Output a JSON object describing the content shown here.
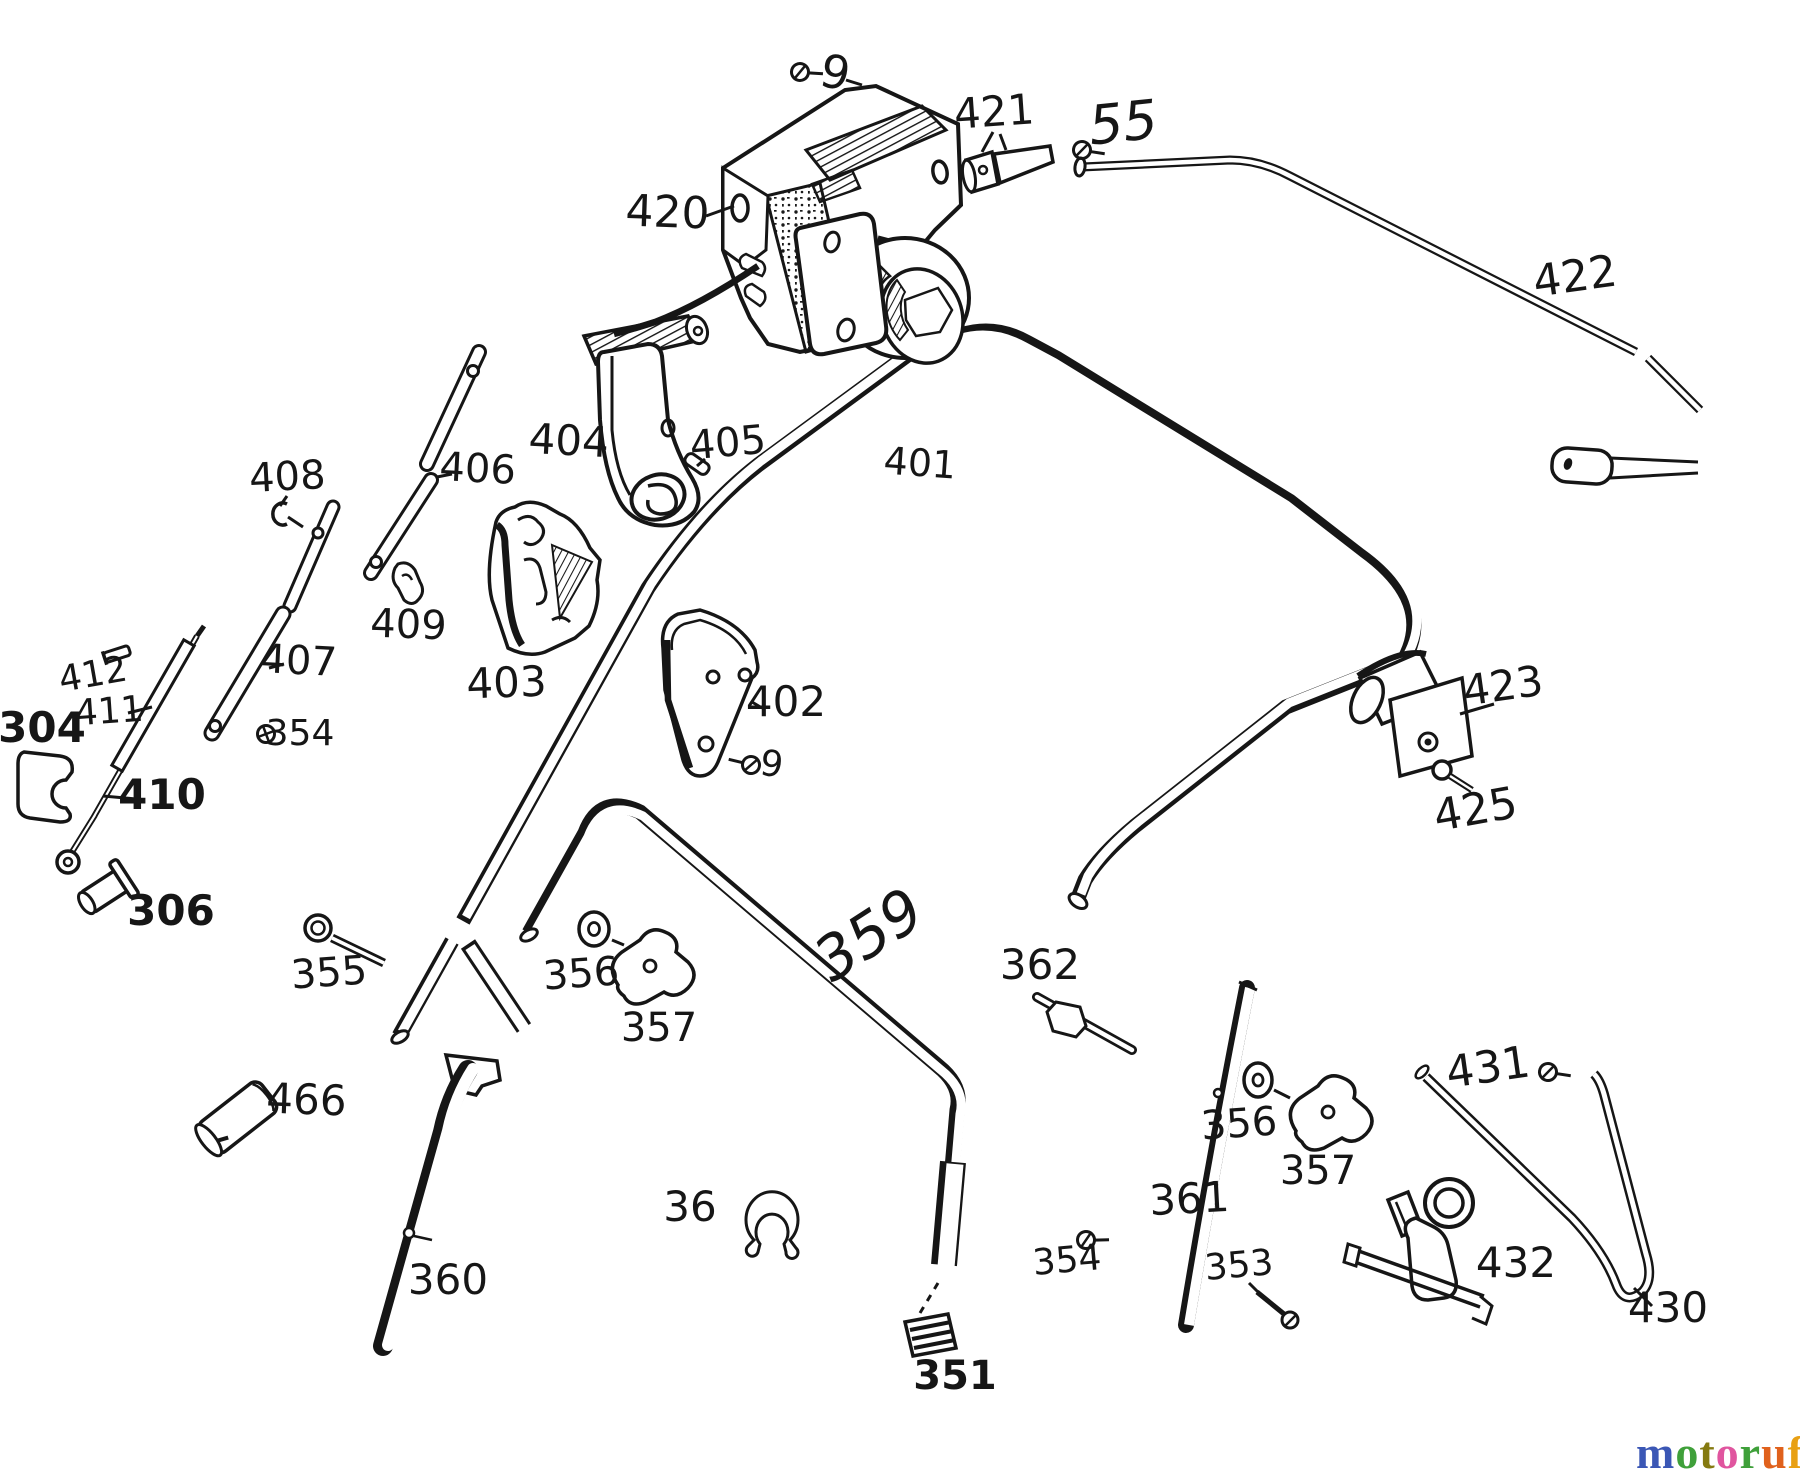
{
  "meta": {
    "background": "#ffffff",
    "ink": "#161616",
    "description": "Exploded spare-parts diagram of a lawn mower handlebar assembly"
  },
  "watermark": {
    "text": "motoruf",
    "suffix": ".de",
    "letters": [
      {
        "ch": "m",
        "color": "#3b57b5"
      },
      {
        "ch": "o",
        "color": "#3fa03a"
      },
      {
        "ch": "t",
        "color": "#857a10"
      },
      {
        "ch": "o",
        "color": "#e0559f"
      },
      {
        "ch": "r",
        "color": "#3fa03a"
      },
      {
        "ch": "u",
        "color": "#e0611c"
      },
      {
        "ch": "f",
        "color": "#e8a014"
      }
    ]
  },
  "diagram": {
    "labels": [
      {
        "id": "9-top",
        "text": "9",
        "x": 832,
        "y": 88,
        "size": 46,
        "rot": 12
      },
      {
        "id": "421",
        "text": "421",
        "x": 995,
        "y": 126,
        "size": 42,
        "rot": -4
      },
      {
        "id": "55",
        "text": "55",
        "x": 1125,
        "y": 141,
        "size": 54,
        "rot": -6,
        "style": "script"
      },
      {
        "id": "420",
        "text": "420",
        "x": 667,
        "y": 227,
        "size": 44,
        "rot": 2
      },
      {
        "id": "422",
        "text": "422",
        "x": 1577,
        "y": 291,
        "size": 44,
        "rot": -8
      },
      {
        "id": "404",
        "text": "404",
        "x": 568,
        "y": 455,
        "size": 42,
        "rot": 3
      },
      {
        "id": "405",
        "text": "405",
        "x": 729,
        "y": 456,
        "size": 40,
        "rot": -5
      },
      {
        "id": "406",
        "text": "406",
        "x": 477,
        "y": 482,
        "size": 40,
        "rot": 3
      },
      {
        "id": "408",
        "text": "408",
        "x": 288,
        "y": 490,
        "size": 40,
        "rot": -3
      },
      {
        "id": "401",
        "text": "401",
        "x": 919,
        "y": 476,
        "size": 38,
        "rot": 4
      },
      {
        "id": "409",
        "text": "409",
        "x": 408,
        "y": 638,
        "size": 40,
        "rot": 2
      },
      {
        "id": "412",
        "text": "412",
        "x": 95,
        "y": 686,
        "size": 36,
        "rot": -10
      },
      {
        "id": "407",
        "text": "407",
        "x": 298,
        "y": 674,
        "size": 40,
        "rot": 3
      },
      {
        "id": "411",
        "text": "411",
        "x": 110,
        "y": 723,
        "size": 36,
        "rot": -4
      },
      {
        "id": "304",
        "text": "304",
        "x": 42,
        "y": 742,
        "size": 42,
        "rot": 0,
        "weight": 700
      },
      {
        "id": "354-left",
        "text": "354",
        "x": 300,
        "y": 745,
        "size": 36,
        "rot": 0
      },
      {
        "id": "403",
        "text": "403",
        "x": 507,
        "y": 697,
        "size": 42,
        "rot": -2
      },
      {
        "id": "402",
        "text": "402",
        "x": 786,
        "y": 716,
        "size": 42,
        "rot": 0
      },
      {
        "id": "9-mid",
        "text": "9",
        "x": 770,
        "y": 776,
        "size": 36,
        "rot": 8
      },
      {
        "id": "423",
        "text": "423",
        "x": 1505,
        "y": 700,
        "size": 42,
        "rot": -8
      },
      {
        "id": "425",
        "text": "425",
        "x": 1478,
        "y": 824,
        "size": 44,
        "rot": -10
      },
      {
        "id": "410",
        "text": "410",
        "x": 162,
        "y": 809,
        "size": 42,
        "rot": 0,
        "weight": 700
      },
      {
        "id": "306",
        "text": "306",
        "x": 171,
        "y": 925,
        "size": 42,
        "rot": 0,
        "weight": 700
      },
      {
        "id": "355",
        "text": "355",
        "x": 330,
        "y": 986,
        "size": 40,
        "rot": -4
      },
      {
        "id": "356-left",
        "text": "356",
        "x": 582,
        "y": 987,
        "size": 40,
        "rot": -4
      },
      {
        "id": "357-left",
        "text": "357",
        "x": 659,
        "y": 1041,
        "size": 40,
        "rot": 0
      },
      {
        "id": "359",
        "text": "359",
        "x": 880,
        "y": 952,
        "size": 60,
        "rot": -33,
        "style": "script"
      },
      {
        "id": "362",
        "text": "362",
        "x": 1040,
        "y": 979,
        "size": 42,
        "rot": 0
      },
      {
        "id": "466",
        "text": "466",
        "x": 306,
        "y": 1114,
        "size": 42,
        "rot": 2
      },
      {
        "id": "431",
        "text": "431",
        "x": 1490,
        "y": 1082,
        "size": 44,
        "rot": -8
      },
      {
        "id": "356-right",
        "text": "356",
        "x": 1240,
        "y": 1137,
        "size": 40,
        "rot": -4
      },
      {
        "id": "357-right",
        "text": "357",
        "x": 1318,
        "y": 1184,
        "size": 40,
        "rot": 0
      },
      {
        "id": "36",
        "text": "36",
        "x": 690,
        "y": 1221,
        "size": 42,
        "rot": 0
      },
      {
        "id": "361",
        "text": "361",
        "x": 1190,
        "y": 1213,
        "size": 42,
        "rot": -3
      },
      {
        "id": "354-bottom",
        "text": "354",
        "x": 1068,
        "y": 1272,
        "size": 36,
        "rot": -5
      },
      {
        "id": "353",
        "text": "353",
        "x": 1240,
        "y": 1277,
        "size": 36,
        "rot": -5
      },
      {
        "id": "432",
        "text": "432",
        "x": 1516,
        "y": 1277,
        "size": 42,
        "rot": 0
      },
      {
        "id": "360",
        "text": "360",
        "x": 448,
        "y": 1294,
        "size": 42,
        "rot": 0
      },
      {
        "id": "430",
        "text": "430",
        "x": 1668,
        "y": 1322,
        "size": 42,
        "rot": 0
      },
      {
        "id": "351",
        "text": "351",
        "x": 955,
        "y": 1389,
        "size": 40,
        "rot": 0,
        "weight": 700
      }
    ],
    "glyphs": [
      {
        "id": "screw-9-top",
        "type": "screw",
        "x": 800,
        "y": 72,
        "rot": -30
      },
      {
        "id": "screw-55",
        "type": "screw",
        "x": 1082,
        "y": 150,
        "rot": -25
      },
      {
        "id": "screw-354-left",
        "type": "cross",
        "x": 266,
        "y": 734,
        "rot": 0
      },
      {
        "id": "screw-9-mid",
        "type": "screw",
        "x": 751,
        "y": 765,
        "rot": 160
      },
      {
        "id": "screw-354-bottom",
        "type": "screw",
        "x": 1086,
        "y": 1240,
        "rot": -35
      },
      {
        "id": "screw-431",
        "type": "screw",
        "x": 1548,
        "y": 1072,
        "rot": -25
      }
    ],
    "leaders": [
      {
        "x1": 846,
        "y1": 80,
        "x2": 862,
        "y2": 85
      },
      {
        "x1": 993,
        "y1": 132,
        "x2": 982,
        "y2": 152
      },
      {
        "x1": 706,
        "y1": 216,
        "x2": 734,
        "y2": 206
      },
      {
        "x1": 452,
        "y1": 474,
        "x2": 437,
        "y2": 477
      },
      {
        "x1": 287,
        "y1": 496,
        "x2": 280,
        "y2": 506
      },
      {
        "x1": 705,
        "y1": 459,
        "x2": 697,
        "y2": 466
      },
      {
        "x1": 128,
        "y1": 713,
        "x2": 152,
        "y2": 707
      },
      {
        "x1": 103,
        "y1": 796,
        "x2": 136,
        "y2": 799
      },
      {
        "x1": 269,
        "y1": 668,
        "x2": 284,
        "y2": 664
      },
      {
        "x1": 762,
        "y1": 708,
        "x2": 752,
        "y2": 702
      },
      {
        "x1": 1494,
        "y1": 704,
        "x2": 1460,
        "y2": 714
      },
      {
        "x1": 612,
        "y1": 940,
        "x2": 624,
        "y2": 945
      },
      {
        "x1": 1274,
        "y1": 1090,
        "x2": 1290,
        "y2": 1098
      },
      {
        "x1": 1249,
        "y1": 1283,
        "x2": 1258,
        "y2": 1292
      },
      {
        "x1": 1634,
        "y1": 1288,
        "x2": 1652,
        "y2": 1306
      },
      {
        "x1": 938,
        "y1": 1283,
        "x2": 920,
        "y2": 1313,
        "dashed": true
      }
    ]
  }
}
